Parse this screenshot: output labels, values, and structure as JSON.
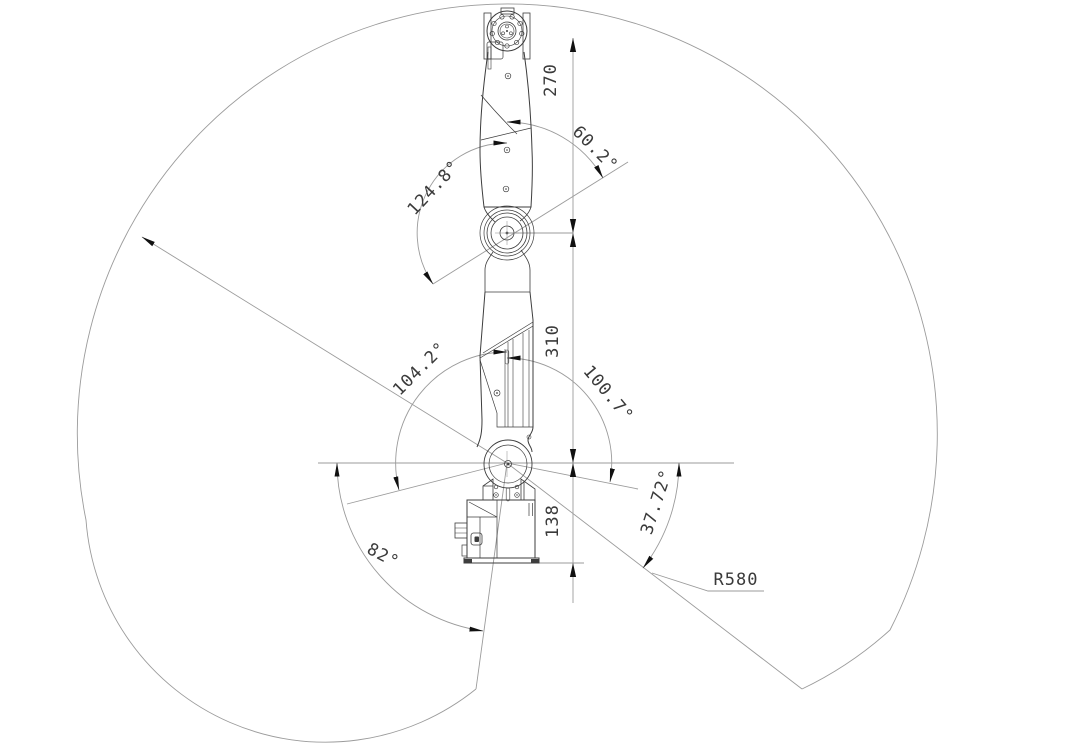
{
  "drawing": {
    "kind": "robot-arm-work-envelope-cad-drawing",
    "background": "#ffffff"
  },
  "colors": {
    "outline": "#3d3d3d",
    "detail": "#4a4a4a",
    "construction": "#9b9b9b",
    "arrow": "#111111",
    "text": "#3a3a3a"
  },
  "dimensions": {
    "d270": "270",
    "d310": "310",
    "d138": "138",
    "a60_2": "60.2°",
    "a124_8": "124.8°",
    "a104_2": "104.2°",
    "a100_7": "100.7°",
    "a82": "82°",
    "a37_72": "37.72°",
    "r580": "R580"
  },
  "measurements": [
    {
      "label": "270",
      "type": "linear",
      "value": 270,
      "unit": "mm",
      "between": "wrist-flange-top and elbow-joint-center"
    },
    {
      "label": "310",
      "type": "linear",
      "value": 310,
      "unit": "mm",
      "between": "elbow-joint-center and shoulder-joint-center"
    },
    {
      "label": "138",
      "type": "linear",
      "value": 138,
      "unit": "mm",
      "between": "shoulder-joint-center and base-bottom"
    },
    {
      "label": "60.2°",
      "type": "angular",
      "value": 60.2,
      "unit": "deg",
      "at": "elbow-joint upper sweep"
    },
    {
      "label": "124.8°",
      "type": "angular",
      "value": 124.8,
      "unit": "deg",
      "at": "elbow-joint lower sweep"
    },
    {
      "label": "104.2°",
      "type": "angular",
      "value": 104.2,
      "unit": "deg",
      "at": "shoulder-joint left sweep"
    },
    {
      "label": "100.7°",
      "type": "angular",
      "value": 100.7,
      "unit": "deg",
      "at": "shoulder-joint right sweep"
    },
    {
      "label": "82°",
      "type": "angular",
      "value": 82,
      "unit": "deg",
      "at": "shoulder-joint lower-left sweep"
    },
    {
      "label": "37.72°",
      "type": "angular",
      "value": 37.72,
      "unit": "deg",
      "at": "shoulder-joint lower-right sweep"
    },
    {
      "label": "R580",
      "type": "radius",
      "value": 580,
      "unit": "mm",
      "of": "work-envelope reach radius"
    }
  ]
}
